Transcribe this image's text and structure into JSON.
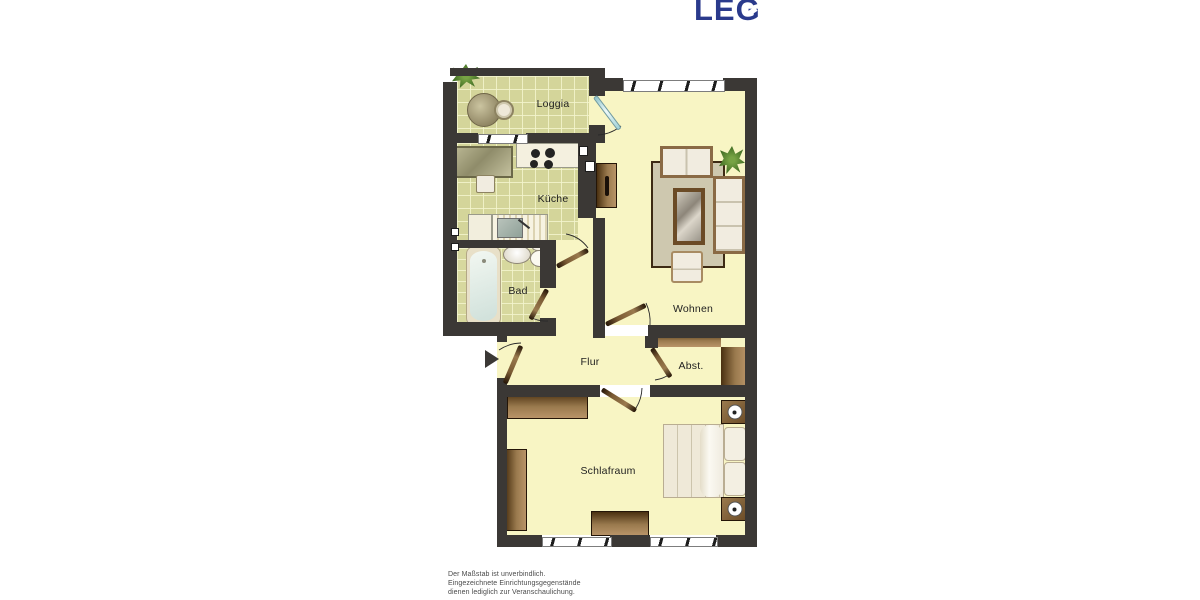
{
  "logo": {
    "text": "LEG",
    "color": "#2a3a8c"
  },
  "rooms": {
    "loggia": {
      "label": "Loggia"
    },
    "kueche": {
      "label": "Küche"
    },
    "bad": {
      "label": "Bad"
    },
    "flur": {
      "label": "Flur"
    },
    "wohnen": {
      "label": "Wohnen"
    },
    "abstellraum": {
      "label": "Abst."
    },
    "schlafraum": {
      "label": "Schlafraum"
    }
  },
  "disclaimer": {
    "lines": [
      "Der Maßstab ist unverbindlich.",
      "Eingezeichnete Einrichtungsgegenstände",
      "dienen lediglich zur Veranschaulichung."
    ]
  },
  "icons": {
    "entrance_arrow": "right-pointing solid triangle marking the apartment entrance"
  },
  "colors": {
    "wall": "#3b3835",
    "tile_floor": "#d4d59a",
    "plain_floor": "#f8f5c4",
    "furniture_brown": "#7a5a33",
    "logo_blue": "#2a3a8c"
  }
}
